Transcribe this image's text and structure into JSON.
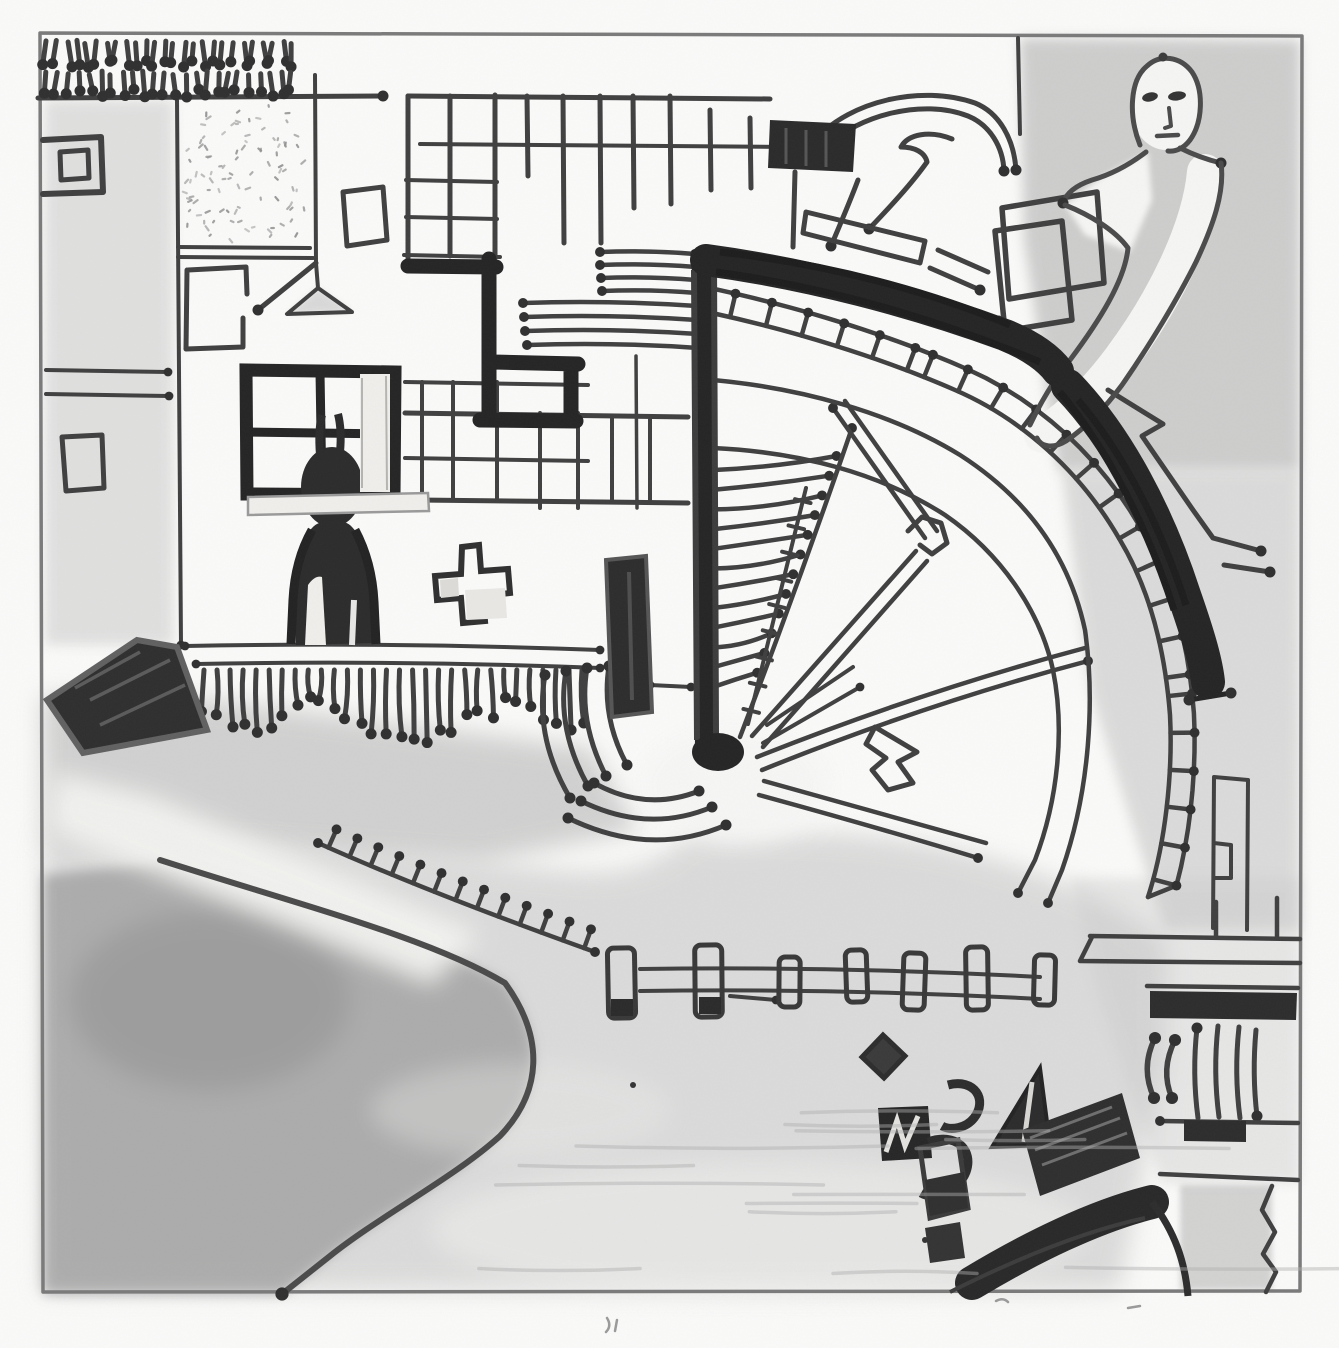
{
  "title": "Hand-drawn aerial site-plan sketch (marker and pencil, no text)",
  "palette": {
    "paper": "#fbfbfa",
    "ink": "#3f3f3f",
    "ink_dark": "#242424",
    "ink_mid": "#4a4a4a",
    "pencil": "#8f8f8f",
    "pencil_border": "#7a7a7a",
    "wash": "#c4c4c4",
    "wash_dark": "#9a9a9a",
    "highlight": "#f0efec"
  },
  "scene": {
    "description": "Child-like plan drawing: hatched top border, gridded buildings top-left, dark four-pane window with a dark human silhouette, fan-shaped amphitheater with radial aisles and a thick dark curved road, ladder-like curved track, person with long reaching arm top-right, shaded beach and pond bottom-left, post-and-rail pier across the bottom, cluster of dark boat shapes bottom-right.",
    "counts": {
      "top_hatch_row1": 26,
      "top_hatch_row2": 24,
      "stipple_specks": 95,
      "fringe_tassels": 30,
      "fan_lines": 12,
      "fan_ladder_ticks": 9,
      "arc_ladder_rungs": 24,
      "comb_ticks": 13,
      "fence_posts": 7,
      "beach_streaks": 14
    },
    "elements": [
      "frame-border",
      "top-hatch-rows",
      "square-in-square",
      "stipple-square",
      "hanging-lamp",
      "tilted-card",
      "gapped-square",
      "dark-window",
      "window-sill-highlight",
      "person-silhouette",
      "plus-shape",
      "fringe-wall",
      "grid-building",
      "dark-stepped-wall",
      "hatch-stacks",
      "amphitheater-fan",
      "radial-aisles",
      "hook-gate",
      "arrow-polygon",
      "seating-rings",
      "curved-ladder-track",
      "dark-curved-road",
      "stair-zigzag",
      "dome-arcs",
      "curl-lines",
      "bench-slab",
      "tilted-rect-buildings",
      "dark-entrance-block",
      "monolith-slab",
      "ripple-arcs",
      "figure-person",
      "beach-wash",
      "pond",
      "shoreline",
      "diagonal-comb",
      "post-rail-fence",
      "wharf",
      "right-column-structures",
      "boat-cluster",
      "narrow-building",
      "grain-texture"
    ]
  }
}
